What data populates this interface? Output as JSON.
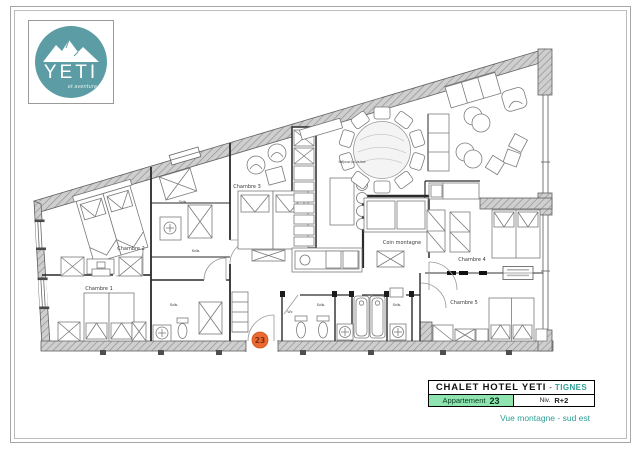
{
  "logo": {
    "brand": "YETI",
    "tagline": "et aventure"
  },
  "title_block": {
    "hotel_name": "CHALET HOTEL YETI",
    "separator": "-",
    "location": "TIGNES",
    "apartment_label": "Appartement",
    "apartment_number": "23",
    "level_label": "Niv.",
    "level_value": "R+2",
    "view_caption": "Vue montagne - sud est"
  },
  "plan": {
    "labels": {
      "chambre1": "Chambre 1",
      "chambre2": "Chambre 2",
      "chambre3": "Chambre 3",
      "chambre4": "Chambre 4",
      "chambre5": "Chambre 5",
      "coin_montagne": "Coin montagne",
      "sejour_cuisine": "Séjour/cuisine",
      "sdb": "Sdb.",
      "wc": "Wc"
    },
    "entrance_badge": "23"
  },
  "colors": {
    "logo_teal": "#5c9ca4",
    "title_teal": "#2fa096",
    "apartment_green": "#8fe3ae",
    "badge_orange": "#ec6a2f",
    "wall_gray": "#cfcfcf"
  }
}
